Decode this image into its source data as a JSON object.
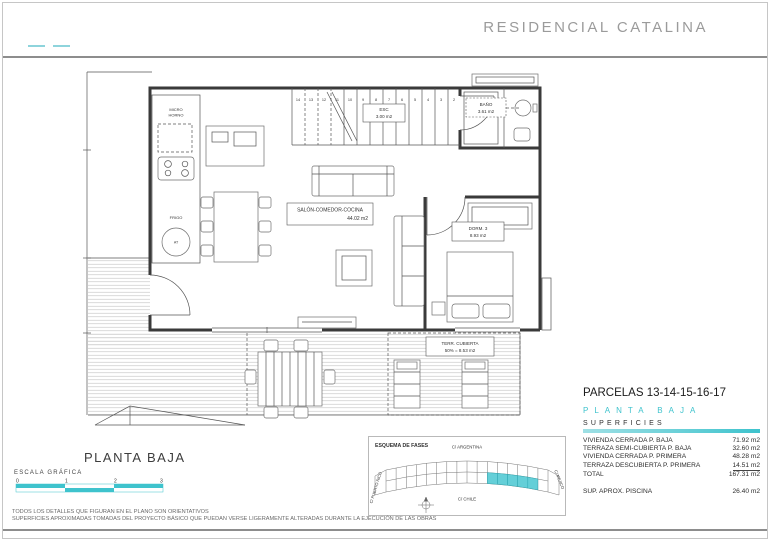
{
  "header": {
    "title": "RESIDENCIAL CATALINA"
  },
  "plan": {
    "salon": {
      "label": "SALÓN-COMEDOR-COCINA",
      "area": "44.02 m2"
    },
    "esc": {
      "label": "ESC",
      "area": "3.00 m2"
    },
    "bano": {
      "label": "BAÑO",
      "area": "3.61 m2"
    },
    "dorm": {
      "label": "DORM. 3",
      "area": "8.93 m2"
    },
    "terraza": {
      "label": "TERR. CUBIERTA",
      "area": "50% = 8.53 m2"
    },
    "kitchen": {
      "micro": "MICRO",
      "horno": "HORNO",
      "frigo": "FRIGO",
      "at": "AT"
    },
    "stairs": {
      "numbers": [
        "14",
        "13",
        "12",
        "11",
        "10",
        "9",
        "8",
        "7",
        "6",
        "5",
        "4",
        "3",
        "2"
      ]
    }
  },
  "titleblock": {
    "plan_title": "PLANTA BAJA",
    "scale_label": "ESCALA GRÁFICA",
    "scale_ticks": [
      "0",
      "1",
      "2",
      "3"
    ]
  },
  "fases": {
    "title": "ESQUEMA DE FASES",
    "streets": {
      "top": "C/ ARGENTINA",
      "bottom": "C/ CHILE",
      "left": "C/ PUERTO RICO",
      "right": "C/ MEJICO"
    }
  },
  "parcelas": {
    "title": "PARCELAS 13-14-15-16-17",
    "subtitle": "PLANTA BAJA",
    "section": "SUPERFICIES",
    "rows": [
      {
        "label": "VIVIENDA CERRADA P. BAJA",
        "value": "71.92 m2"
      },
      {
        "label": "TERRAZA SEMI-CUBIERTA P. BAJA",
        "value": "32.60 m2"
      },
      {
        "label": "VIVIENDA CERRADA P. PRIMERA",
        "value": "48.28 m2"
      },
      {
        "label": "TERRAZA DESCUBIERTA P. PRIMERA",
        "value": "14.51 m2"
      },
      {
        "label": "TOTAL",
        "value": "167.31 m2"
      }
    ],
    "piscina": {
      "label": "SUP.  APROX.  PISCINA",
      "value": "26.40 m2"
    }
  },
  "disclaimer": {
    "line1": "TODOS LOS DETALLES QUE FIGURAN EN EL PLANO SON ORIENTATIVOS",
    "line2": "SUPERFICIES APROXIMADAS TOMADAS DEL PROYECTO BÁSICO QUE PUEDAN VERSE LIGERAMENTE ALTERADAS DURANTE LA EJECUCIÓN DE LAS OBRAS"
  },
  "colors": {
    "accent": "#3EC3CD",
    "header_text": "#9B9B9B"
  }
}
